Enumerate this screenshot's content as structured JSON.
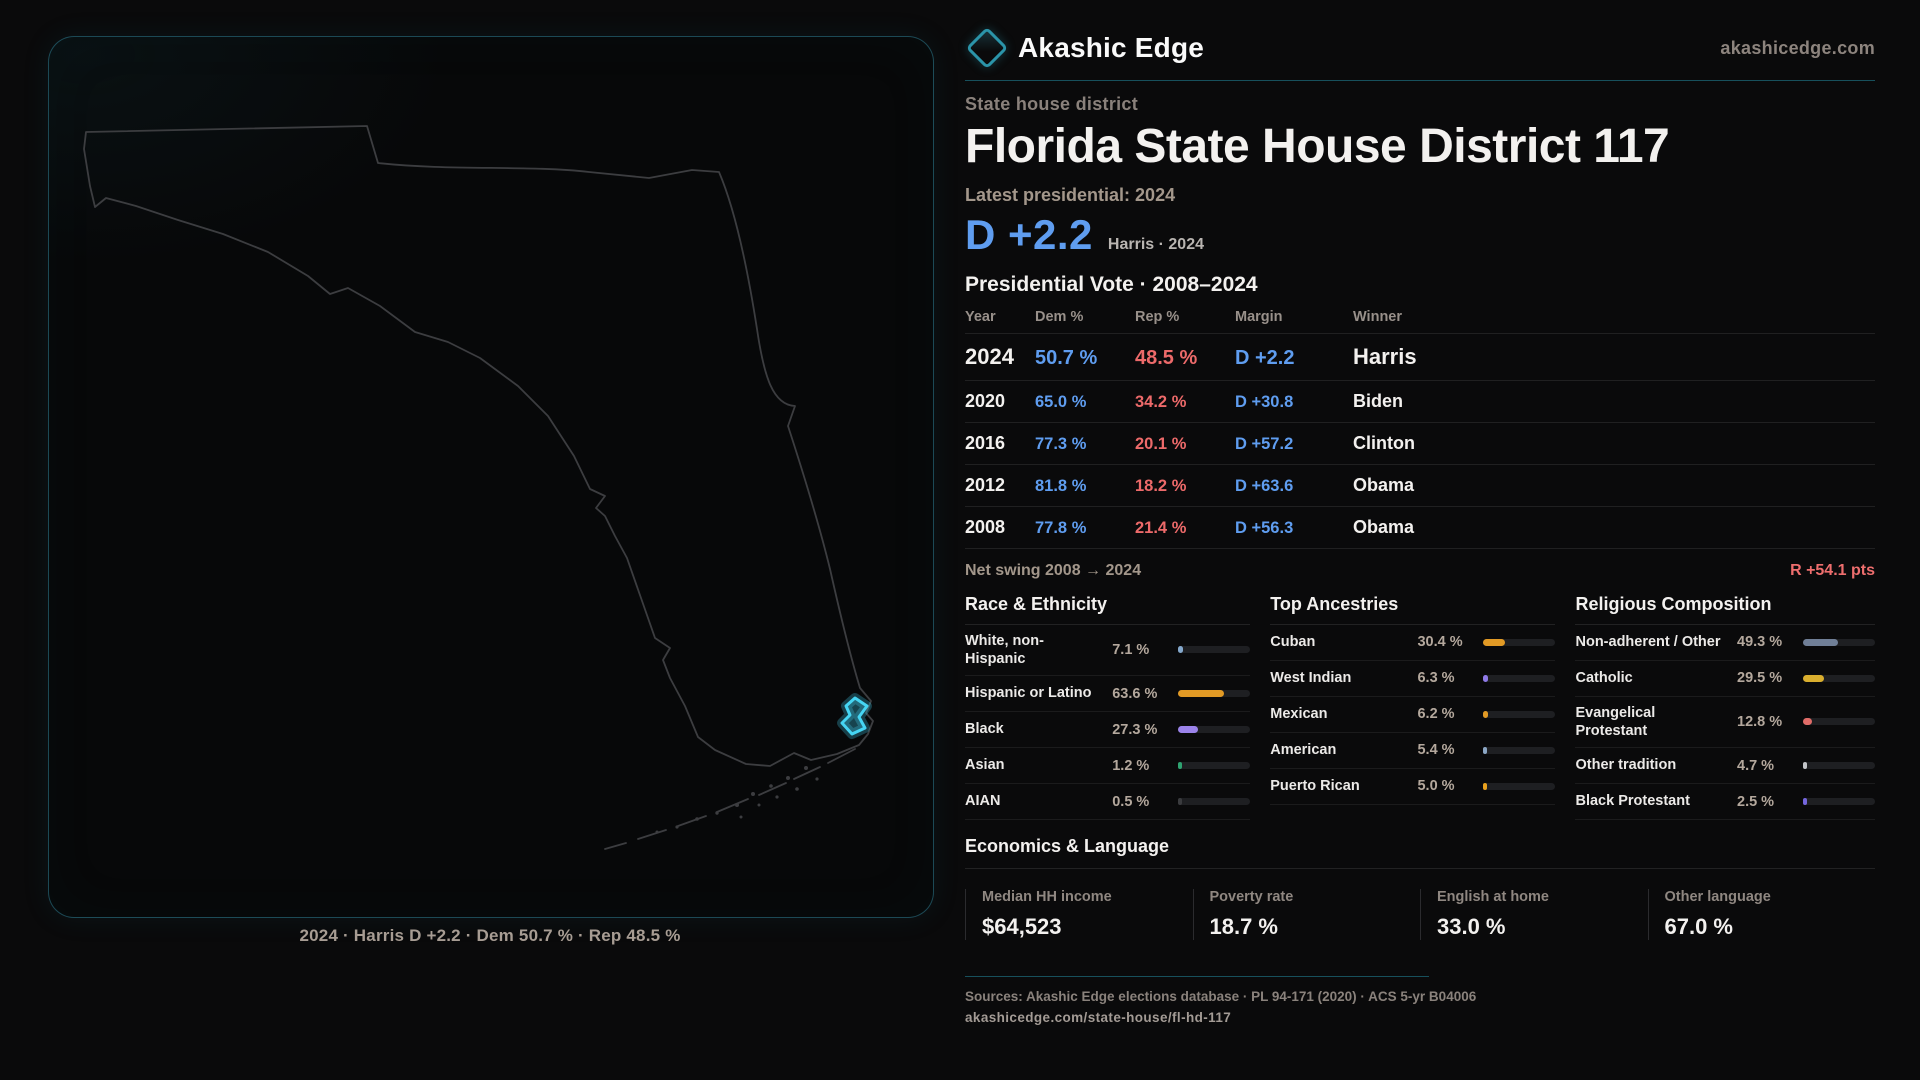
{
  "brand": {
    "name": "Akashic Edge",
    "domain": "akashicedge.com"
  },
  "header": {
    "kicker": "State house district",
    "title": "Florida State House District 117",
    "latest_label": "Latest presidential: 2024",
    "margin_big": "D +2.2",
    "margin_context": "Harris · 2024"
  },
  "table": {
    "title": "Presidential Vote · 2008–2024",
    "columns": [
      "Year",
      "Dem %",
      "Rep %",
      "Margin",
      "Winner"
    ],
    "rows": [
      {
        "year": "2024",
        "dem": "50.7 %",
        "rep": "48.5 %",
        "margin": "D +2.2",
        "winner": "Harris"
      },
      {
        "year": "2020",
        "dem": "65.0 %",
        "rep": "34.2 %",
        "margin": "D +30.8",
        "winner": "Biden"
      },
      {
        "year": "2016",
        "dem": "77.3 %",
        "rep": "20.1 %",
        "margin": "D +57.2",
        "winner": "Clinton"
      },
      {
        "year": "2012",
        "dem": "81.8 %",
        "rep": "18.2 %",
        "margin": "D +63.6",
        "winner": "Obama"
      },
      {
        "year": "2008",
        "dem": "77.8 %",
        "rep": "21.4 %",
        "margin": "D +56.3",
        "winner": "Obama"
      }
    ]
  },
  "net_swing": {
    "label": "Net swing 2008 → 2024",
    "value": "R +54.1 pts"
  },
  "demographics": [
    {
      "title": "Race & Ethnicity",
      "rows": [
        {
          "label": "White, non-Hispanic",
          "value": "7.1 %",
          "pct": 7.1,
          "color": "#84a8cc"
        },
        {
          "label": "Hispanic or Latino",
          "value": "63.6 %",
          "pct": 63.6,
          "color": "#e29a25"
        },
        {
          "label": "Black",
          "value": "27.3 %",
          "pct": 27.3,
          "color": "#9b83ea"
        },
        {
          "label": "Asian",
          "value": "1.2 %",
          "pct": 1.2,
          "color": "#2fa371"
        },
        {
          "label": "AIAN",
          "value": "0.5 %",
          "pct": 0.5,
          "color": "#3a3b3e"
        }
      ]
    },
    {
      "title": "Top Ancestries",
      "rows": [
        {
          "label": "Cuban",
          "value": "30.4 %",
          "pct": 30.4,
          "color": "#e29a25"
        },
        {
          "label": "West Indian",
          "value": "6.3 %",
          "pct": 6.3,
          "color": "#8f7ae8"
        },
        {
          "label": "Mexican",
          "value": "6.2 %",
          "pct": 6.2,
          "color": "#e29a25"
        },
        {
          "label": "American",
          "value": "5.4 %",
          "pct": 5.4,
          "color": "#8ba6c4"
        },
        {
          "label": "Puerto Rican",
          "value": "5.0 %",
          "pct": 5.0,
          "color": "#e8a11e"
        }
      ]
    },
    {
      "title": "Religious Composition",
      "rows": [
        {
          "label": "Non-adherent / Other",
          "value": "49.3 %",
          "pct": 49.3,
          "color": "#707f97"
        },
        {
          "label": "Catholic",
          "value": "29.5 %",
          "pct": 29.5,
          "color": "#d9ae2e"
        },
        {
          "label": "Evangelical Protestant",
          "value": "12.8 %",
          "pct": 12.8,
          "color": "#e06c68"
        },
        {
          "label": "Other tradition",
          "value": "4.7 %",
          "pct": 4.7,
          "color": "#c2c4c8"
        },
        {
          "label": "Black Protestant",
          "value": "2.5 %",
          "pct": 2.5,
          "color": "#7466dd"
        }
      ]
    }
  ],
  "economics": {
    "title": "Economics & Language",
    "stats": [
      {
        "label": "Median HH income",
        "value": "$64,523"
      },
      {
        "label": "Poverty rate",
        "value": "18.7 %"
      },
      {
        "label": "English at home",
        "value": "33.0 %"
      },
      {
        "label": "Other language",
        "value": "67.0 %"
      }
    ]
  },
  "footer": {
    "sources": "Sources: Akashic Edge elections database · PL 94-171 (2020) · ACS 5-yr B04006",
    "permalink": "akashicedge.com/state-house/fl-hd-117"
  },
  "map": {
    "caption": "2024 · Harris D +2.2 · Dem 50.7 % · Rep 48.5 %",
    "district_color": "#45d5f3",
    "outline_color": "#3c3d40"
  }
}
